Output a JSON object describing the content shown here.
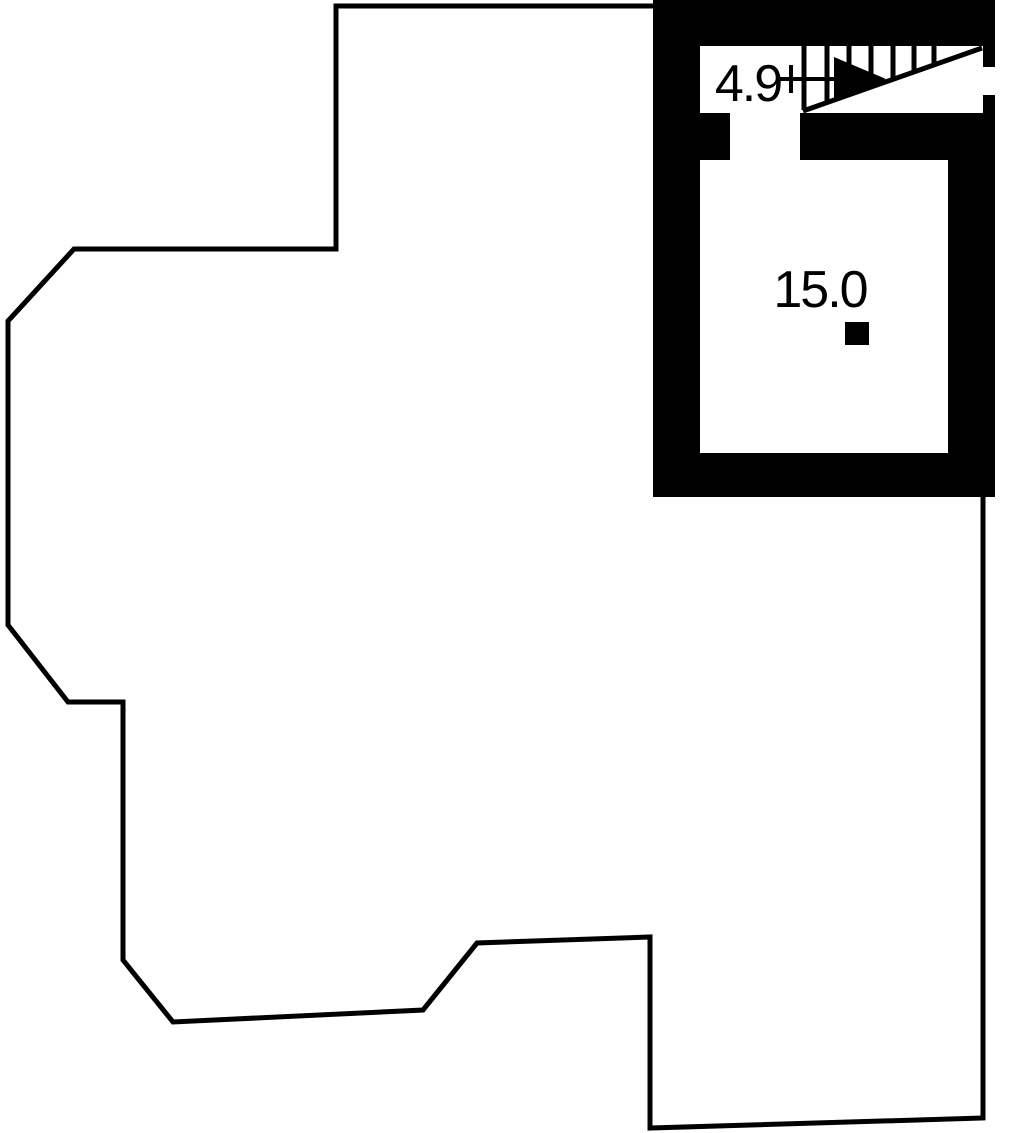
{
  "floor_plan": {
    "background_color": "#ffffff",
    "line_color": "#000000",
    "rooms": [
      {
        "name": "stairwell",
        "area": 4.9,
        "area_label": "4.9"
      },
      {
        "name": "room",
        "area": 15.0,
        "area_label": "15.0"
      }
    ],
    "symbols": [
      {
        "name": "stair-direction-arrow",
        "meaning": "direction of stair run"
      },
      {
        "name": "chimney-marker",
        "meaning": "solid square marker in room"
      }
    ]
  }
}
